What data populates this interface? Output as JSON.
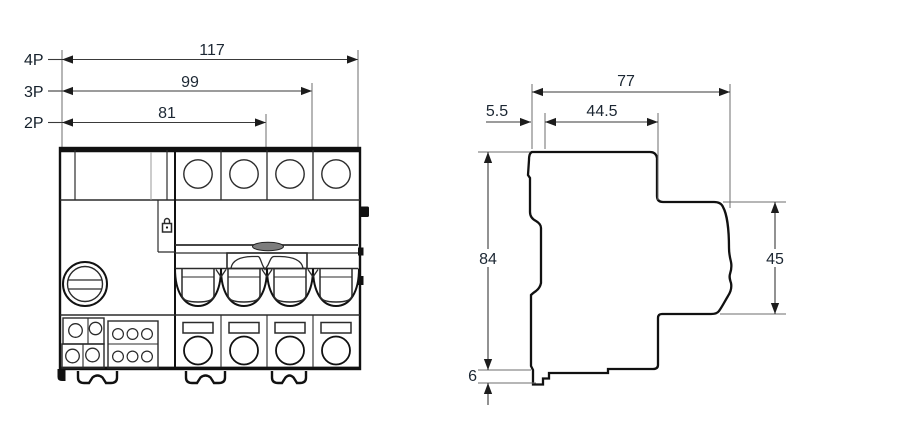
{
  "front_view": {
    "pole_width_dims": [
      {
        "label": "4P",
        "value": "117"
      },
      {
        "label": "3P",
        "value": "99"
      },
      {
        "label": "2P",
        "value": "81"
      }
    ]
  },
  "side_view": {
    "depth_total": "77",
    "depth_rail_offset": "5.5",
    "depth_upper": "44.5",
    "height_total": "84",
    "height_front": "45",
    "clip_depth": "6"
  },
  "colors": {
    "line": "#111111",
    "dim_line": "#3a3a3a",
    "dim_text": "#1c2733",
    "background": "#ffffff",
    "handle_hump": "#7d7d7d"
  }
}
